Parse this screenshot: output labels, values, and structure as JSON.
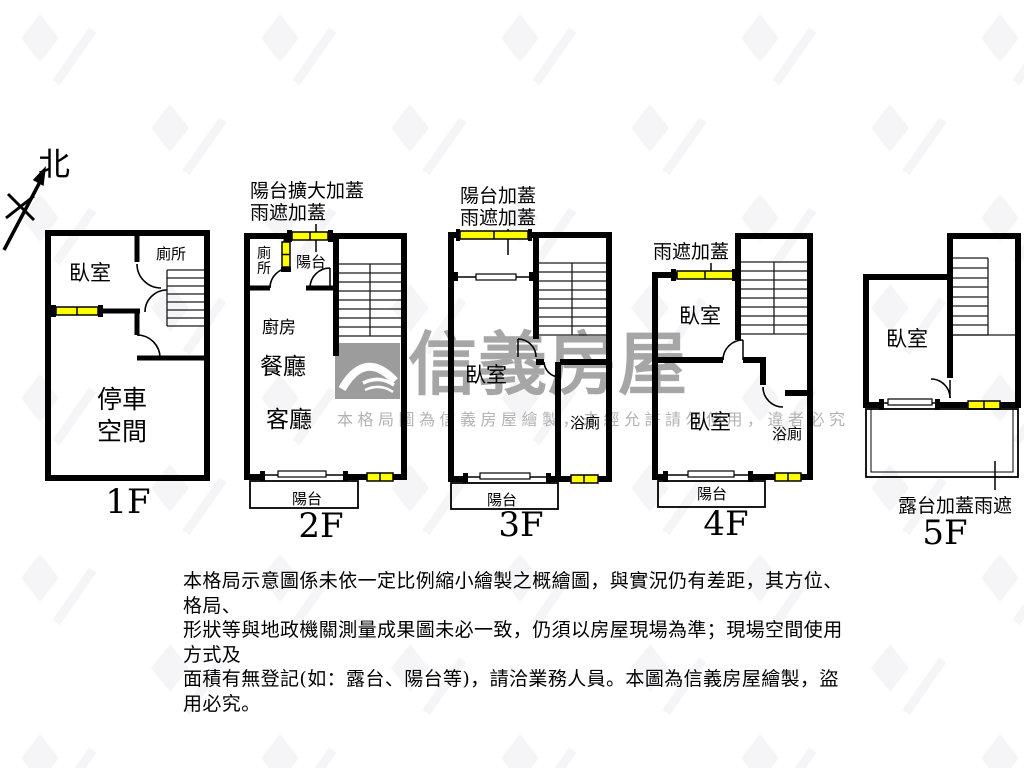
{
  "north": {
    "label": "北"
  },
  "floors": [
    {
      "label": "1F",
      "rooms": {
        "bedroom": "臥室",
        "toilet": "廁所",
        "parking_line1": "停車",
        "parking_line2": "空間"
      }
    },
    {
      "label": "2F",
      "annotations": {
        "line1": "陽台擴大加蓋",
        "line2": "雨遮加蓋"
      },
      "rooms": {
        "toilet_char1": "廁",
        "toilet_char2": "所",
        "balcony_top": "陽台",
        "kitchen": "廚房",
        "dining": "餐廳",
        "living": "客廳",
        "balcony": "陽台"
      }
    },
    {
      "label": "3F",
      "annotations": {
        "line1": "陽台加蓋",
        "line2": "雨遮加蓋"
      },
      "rooms": {
        "bedroom": "臥室",
        "bath": "浴廁",
        "balcony": "陽台"
      }
    },
    {
      "label": "4F",
      "annotations": {
        "line1": "雨遮加蓋"
      },
      "rooms": {
        "bedroom_top": "臥室",
        "bedroom": "臥室",
        "bath": "浴廁",
        "balcony": "陽台"
      }
    },
    {
      "label": "5F",
      "annotations": {
        "terrace": "露台加蓋雨遮"
      },
      "rooms": {
        "bedroom": "臥室"
      }
    }
  ],
  "watermark": {
    "title": "信義房屋",
    "subtitle": "本格局圖為信義房屋繪製，未經允許請勿使用，違者必究"
  },
  "disclaimer": {
    "line1": "本格局示意圖係未依一定比例縮小繪製之概繪圖，與實況仍有差距，其方位、格局、",
    "line2": "形狀等與地政機關測量成果圖未必一致，仍須以房屋現場為準；現場空間使用方式及",
    "line3": "面積有無登記(如：露台、陽台等)，請洽業務人員。本圖為信義房屋繪製，盜用必究。"
  },
  "colors": {
    "wall": "#000000",
    "window_fill": "#ffff00",
    "watermark_gray": "#a6a6a6"
  }
}
